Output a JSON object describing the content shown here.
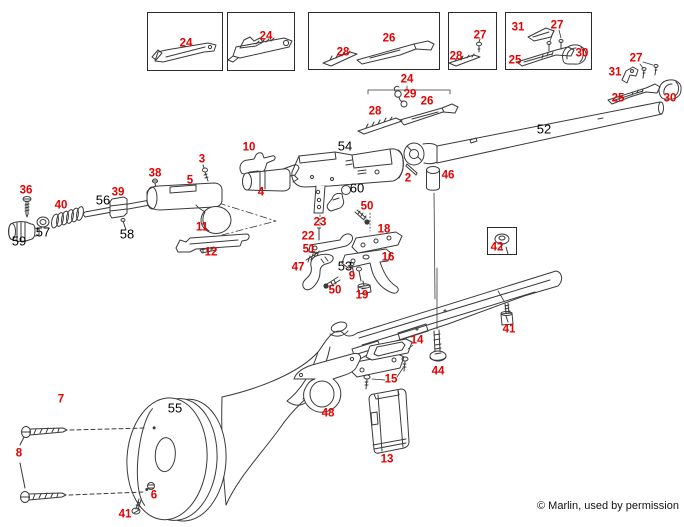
{
  "colors": {
    "label_red": "#e60000",
    "label_black": "#000000",
    "line": "#3a3a3a"
  },
  "footer": {
    "text": "© Marlin, used by permission"
  },
  "insets": [
    {
      "name": "inset-box-1",
      "x": 147,
      "y": 12,
      "w": 76,
      "h": 59
    },
    {
      "name": "inset-box-2",
      "x": 227,
      "y": 12,
      "w": 68,
      "h": 59
    },
    {
      "name": "inset-box-3",
      "x": 308,
      "y": 12,
      "w": 132,
      "h": 58
    },
    {
      "name": "inset-box-4",
      "x": 448,
      "y": 12,
      "w": 49,
      "h": 58
    },
    {
      "name": "inset-box-5",
      "x": 505,
      "y": 12,
      "w": 87,
      "h": 58
    },
    {
      "name": "inset-box-42",
      "x": 487,
      "y": 227,
      "w": 30,
      "h": 28
    }
  ],
  "labels": [
    {
      "text": "24",
      "x": 186,
      "y": 44,
      "tone": "red"
    },
    {
      "text": "24",
      "x": 266,
      "y": 37,
      "tone": "red"
    },
    {
      "text": "28",
      "x": 343,
      "y": 53,
      "tone": "red"
    },
    {
      "text": "26",
      "x": 389,
      "y": 39,
      "tone": "red"
    },
    {
      "text": "27",
      "x": 480,
      "y": 36,
      "tone": "red"
    },
    {
      "text": "28",
      "x": 456,
      "y": 57,
      "tone": "red"
    },
    {
      "text": "31",
      "x": 518,
      "y": 28,
      "tone": "red"
    },
    {
      "text": "27",
      "x": 557,
      "y": 26,
      "tone": "red"
    },
    {
      "text": "25",
      "x": 515,
      "y": 61,
      "tone": "red"
    },
    {
      "text": "30",
      "x": 582,
      "y": 54,
      "tone": "red"
    },
    {
      "text": "24",
      "x": 407,
      "y": 80,
      "tone": "red"
    },
    {
      "text": "29",
      "x": 410,
      "y": 95,
      "tone": "red"
    },
    {
      "text": "26",
      "x": 427,
      "y": 102,
      "tone": "red"
    },
    {
      "text": "28",
      "x": 375,
      "y": 112,
      "tone": "red"
    },
    {
      "text": "27",
      "x": 636,
      "y": 59,
      "tone": "red"
    },
    {
      "text": "31",
      "x": 615,
      "y": 73,
      "tone": "red"
    },
    {
      "text": "25",
      "x": 618,
      "y": 99,
      "tone": "red"
    },
    {
      "text": "30",
      "x": 670,
      "y": 99,
      "tone": "red"
    },
    {
      "text": "52",
      "x": 544,
      "y": 129,
      "tone": "black"
    },
    {
      "text": "54",
      "x": 345,
      "y": 146,
      "tone": "black"
    },
    {
      "text": "10",
      "x": 249,
      "y": 148,
      "tone": "red"
    },
    {
      "text": "3",
      "x": 202,
      "y": 160,
      "tone": "red"
    },
    {
      "text": "38",
      "x": 155,
      "y": 174,
      "tone": "red"
    },
    {
      "text": "5",
      "x": 190,
      "y": 181,
      "tone": "red"
    },
    {
      "text": "4",
      "x": 261,
      "y": 193,
      "tone": "red"
    },
    {
      "text": "39",
      "x": 118,
      "y": 193,
      "tone": "red"
    },
    {
      "text": "36",
      "x": 26,
      "y": 191,
      "tone": "red"
    },
    {
      "text": "40",
      "x": 61,
      "y": 206,
      "tone": "red"
    },
    {
      "text": "56",
      "x": 103,
      "y": 200,
      "tone": "black"
    },
    {
      "text": "57",
      "x": 43,
      "y": 232,
      "tone": "black"
    },
    {
      "text": "59",
      "x": 19,
      "y": 241,
      "tone": "black"
    },
    {
      "text": "58",
      "x": 127,
      "y": 234,
      "tone": "black"
    },
    {
      "text": "11",
      "x": 202,
      "y": 228,
      "tone": "red"
    },
    {
      "text": "12",
      "x": 211,
      "y": 253,
      "tone": "red"
    },
    {
      "text": "2",
      "x": 408,
      "y": 179,
      "tone": "red"
    },
    {
      "text": "46",
      "x": 448,
      "y": 176,
      "tone": "red"
    },
    {
      "text": "60",
      "x": 357,
      "y": 188,
      "tone": "black"
    },
    {
      "text": "50",
      "x": 367,
      "y": 207,
      "tone": "red"
    },
    {
      "text": "23",
      "x": 320,
      "y": 223,
      "tone": "red"
    },
    {
      "text": "22",
      "x": 308,
      "y": 237,
      "tone": "red"
    },
    {
      "text": "18",
      "x": 384,
      "y": 230,
      "tone": "red"
    },
    {
      "text": "51",
      "x": 309,
      "y": 250,
      "tone": "red"
    },
    {
      "text": "16",
      "x": 388,
      "y": 258,
      "tone": "red"
    },
    {
      "text": "47",
      "x": 298,
      "y": 268,
      "tone": "red"
    },
    {
      "text": "53",
      "x": 345,
      "y": 266,
      "tone": "black"
    },
    {
      "text": "9",
      "x": 352,
      "y": 277,
      "tone": "red"
    },
    {
      "text": "50",
      "x": 335,
      "y": 291,
      "tone": "red"
    },
    {
      "text": "19",
      "x": 362,
      "y": 296,
      "tone": "red"
    },
    {
      "text": "42",
      "x": 497,
      "y": 248,
      "tone": "red"
    },
    {
      "text": "41",
      "x": 509,
      "y": 330,
      "tone": "red"
    },
    {
      "text": "14",
      "x": 417,
      "y": 341,
      "tone": "red"
    },
    {
      "text": "44",
      "x": 438,
      "y": 372,
      "tone": "red"
    },
    {
      "text": "15",
      "x": 391,
      "y": 380,
      "tone": "red"
    },
    {
      "text": "48",
      "x": 328,
      "y": 414,
      "tone": "red"
    },
    {
      "text": "13",
      "x": 387,
      "y": 460,
      "tone": "red"
    },
    {
      "text": "55",
      "x": 175,
      "y": 408,
      "tone": "black"
    },
    {
      "text": "7",
      "x": 61,
      "y": 400,
      "tone": "red"
    },
    {
      "text": "8",
      "x": 19,
      "y": 454,
      "tone": "red"
    },
    {
      "text": "6",
      "x": 154,
      "y": 496,
      "tone": "red"
    },
    {
      "text": "41",
      "x": 125,
      "y": 515,
      "tone": "red"
    }
  ]
}
